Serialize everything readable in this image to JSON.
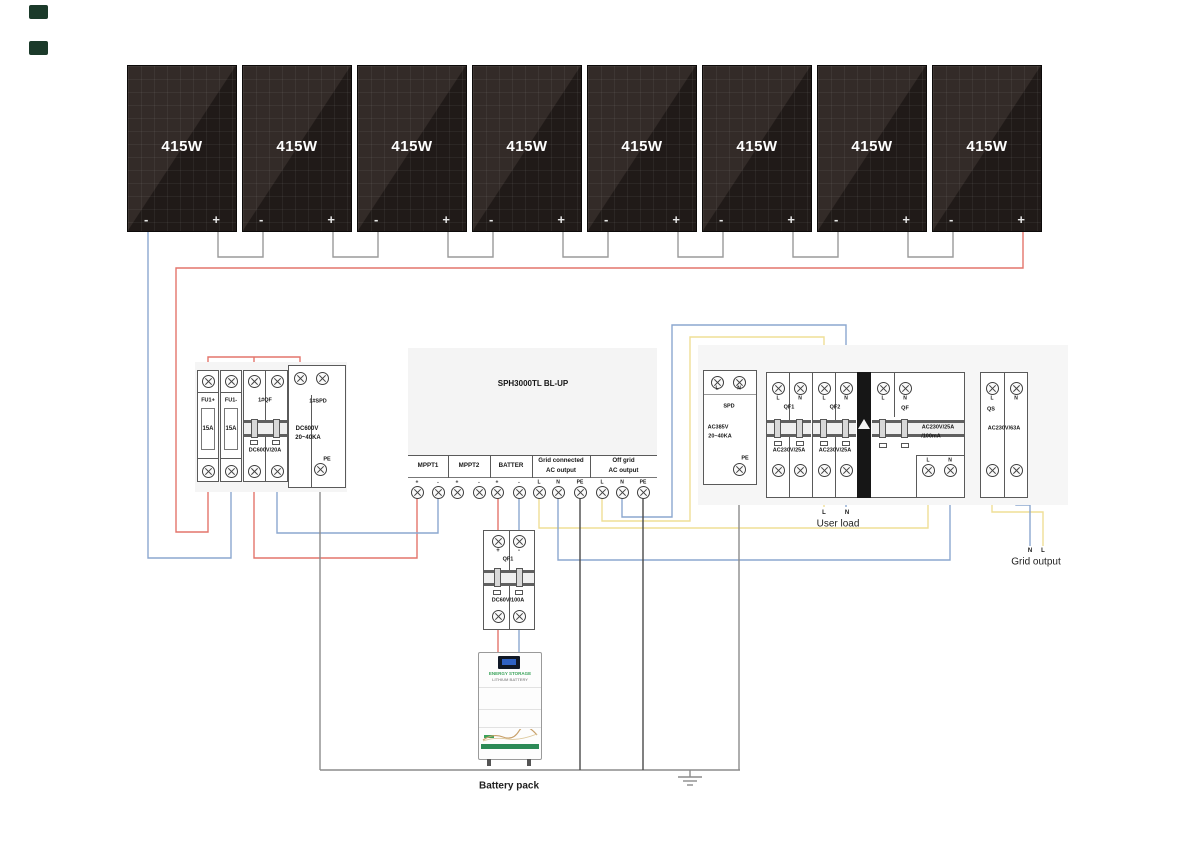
{
  "panels": {
    "count": 8,
    "wattage": "415W",
    "minus": "-",
    "plus": "+"
  },
  "combiner": {
    "fuse1": {
      "label": "FU1+",
      "rating": "15A"
    },
    "fuse2": {
      "label": "FU1-",
      "rating": "15A"
    },
    "breaker": {
      "label": "1#QF",
      "rating": "DC600V/20A"
    },
    "spd": {
      "label": "1#SPD",
      "line1": "DC600V",
      "line2": "20~40KA",
      "pe": "PE"
    }
  },
  "inverter": {
    "title": "SPH3000TL BL-UP",
    "sections": [
      {
        "name_lines": [
          "MPPT1"
        ],
        "terminals": [
          "+",
          "-"
        ]
      },
      {
        "name_lines": [
          "MPPT2"
        ],
        "terminals": [
          "+",
          "-"
        ]
      },
      {
        "name_lines": [
          "BATTER"
        ],
        "terminals": [
          "+",
          "-"
        ]
      },
      {
        "name_lines": [
          "Grid connected",
          "AC output"
        ],
        "terminals": [
          "L",
          "N",
          "PE"
        ]
      },
      {
        "name_lines": [
          "Off grid",
          "AC output"
        ],
        "terminals": [
          "L",
          "N",
          "PE"
        ]
      }
    ]
  },
  "ac_spd": {
    "label": "SPD",
    "line1": "AC385V",
    "line2": "20~40KA",
    "l": "L",
    "n": "N",
    "pe": "PE"
  },
  "qf1": {
    "label": "QF1",
    "rating": "AC230V/25A",
    "l": "L",
    "n": "N"
  },
  "qf2": {
    "label": "QF2",
    "rating": "AC230V/25A",
    "l": "L",
    "n": "N"
  },
  "qf_rcd": {
    "label": "QF",
    "rating1": "AC230V/25A",
    "rating2": "/100mA",
    "l": "L",
    "n": "N",
    "bottom_l": "L",
    "bottom_n": "N"
  },
  "qs": {
    "label": "QS",
    "rating": "AC230V/63A",
    "l": "L",
    "n": "N"
  },
  "battery_breaker": {
    "label": "QF1",
    "rating": "DC60V/100A",
    "plus": "+",
    "minus": "-"
  },
  "battery": {
    "line1": "ENERGY STORAGE",
    "line2": "LITHIUM BATTERY",
    "caption": "Battery pack"
  },
  "labels": {
    "user_load": {
      "l": "L",
      "n": "N",
      "text": "User load"
    },
    "grid_output": {
      "n": "N",
      "l": "L",
      "text": "Grid output"
    }
  },
  "colors": {
    "pv_positive": "#e4756b",
    "pv_negative": "#8ba7cf",
    "line_live": "#efdf96",
    "line_neutral": "#8ba7cf",
    "pe_gray": "#8c8c8c",
    "pe_black": "#4a4a4a",
    "link_gray": "#9a9a9a"
  },
  "wires": [
    {
      "c": "pv_positive",
      "p": [
        [
          1023,
          230
        ],
        [
          1023,
          268
        ],
        [
          176,
          268
        ],
        [
          176,
          532
        ],
        [
          208,
          532
        ],
        [
          208,
          477
        ]
      ]
    },
    {
      "c": "pv_positive",
      "p": [
        [
          208,
          375
        ],
        [
          208,
          357
        ],
        [
          300,
          357
        ],
        [
          300,
          372
        ]
      ]
    },
    {
      "c": "pv_positive",
      "p": [
        [
          254,
          357
        ],
        [
          254,
          375
        ]
      ]
    },
    {
      "c": "pv_positive",
      "p": [
        [
          254,
          477
        ],
        [
          254,
          558
        ],
        [
          417,
          558
        ],
        [
          417,
          498
        ]
      ]
    },
    {
      "c": "pv_positive",
      "p": [
        [
          498,
          498
        ],
        [
          498,
          536
        ]
      ]
    },
    {
      "c": "pv_positive",
      "p": [
        [
          498,
          622
        ],
        [
          498,
          652
        ]
      ]
    },
    {
      "c": "pv_negative",
      "p": [
        [
          148,
          230
        ],
        [
          148,
          558
        ],
        [
          231,
          558
        ],
        [
          231,
          477
        ]
      ]
    },
    {
      "c": "pv_negative",
      "p": [
        [
          231,
          375
        ],
        [
          231,
          364
        ],
        [
          322,
          364
        ],
        [
          322,
          372
        ]
      ]
    },
    {
      "c": "pv_negative",
      "p": [
        [
          277,
          364
        ],
        [
          277,
          375
        ]
      ]
    },
    {
      "c": "pv_negative",
      "p": [
        [
          277,
          477
        ],
        [
          277,
          533
        ],
        [
          438,
          533
        ],
        [
          438,
          498
        ]
      ]
    },
    {
      "c": "pv_negative",
      "p": [
        [
          519,
          498
        ],
        [
          519,
          536
        ]
      ]
    },
    {
      "c": "pv_negative",
      "p": [
        [
          519,
          622
        ],
        [
          519,
          652
        ]
      ]
    },
    {
      "c": "line_live",
      "p": [
        [
          539,
          498
        ],
        [
          539,
          528
        ],
        [
          928,
          528
        ],
        [
          928,
          476
        ]
      ]
    },
    {
      "c": "line_live",
      "p": [
        [
          602,
          498
        ],
        [
          602,
          521
        ],
        [
          690,
          521
        ],
        [
          690,
          337
        ],
        [
          824,
          337
        ],
        [
          824,
          382
        ]
      ]
    },
    {
      "c": "line_live",
      "p": [
        [
          824,
          476
        ],
        [
          824,
          507
        ]
      ]
    },
    {
      "c": "line_live",
      "p": [
        [
          778,
          476
        ],
        [
          778,
          483
        ],
        [
          763,
          483
        ],
        [
          763,
          357
        ],
        [
          717,
          357
        ],
        [
          717,
          376
        ]
      ]
    },
    {
      "c": "line_live",
      "p": [
        [
          763,
          357
        ],
        [
          883,
          357
        ],
        [
          883,
          382
        ]
      ]
    },
    {
      "c": "line_live",
      "p": [
        [
          778,
          382
        ],
        [
          778,
          347
        ],
        [
          992,
          347
        ],
        [
          992,
          382
        ]
      ]
    },
    {
      "c": "line_live",
      "p": [
        [
          992,
          476
        ],
        [
          992,
          512
        ],
        [
          1043,
          512
        ],
        [
          1043,
          546
        ]
      ]
    },
    {
      "c": "line_neutral",
      "p": [
        [
          558,
          498
        ],
        [
          558,
          560
        ],
        [
          950,
          560
        ],
        [
          950,
          476
        ]
      ]
    },
    {
      "c": "line_neutral",
      "p": [
        [
          622,
          498
        ],
        [
          622,
          517
        ],
        [
          672,
          517
        ],
        [
          672,
          325
        ],
        [
          846,
          325
        ],
        [
          846,
          382
        ]
      ]
    },
    {
      "c": "line_neutral",
      "p": [
        [
          846,
          476
        ],
        [
          846,
          507
        ]
      ]
    },
    {
      "c": "line_neutral",
      "p": [
        [
          800,
          476
        ],
        [
          800,
          490
        ],
        [
          748,
          490
        ],
        [
          748,
          365
        ],
        [
          739,
          365
        ],
        [
          739,
          376
        ]
      ]
    },
    {
      "c": "line_neutral",
      "p": [
        [
          748,
          365
        ],
        [
          905,
          365
        ],
        [
          905,
          382
        ]
      ]
    },
    {
      "c": "line_neutral",
      "p": [
        [
          800,
          382
        ],
        [
          800,
          352
        ],
        [
          1016,
          352
        ],
        [
          1016,
          382
        ]
      ]
    },
    {
      "c": "line_neutral",
      "p": [
        [
          1016,
          476
        ],
        [
          1016,
          505
        ],
        [
          1030,
          505
        ],
        [
          1030,
          546
        ]
      ]
    },
    {
      "c": "pe_gray",
      "p": [
        [
          320,
          475
        ],
        [
          320,
          770
        ]
      ]
    },
    {
      "c": "pe_gray",
      "p": [
        [
          739,
          475
        ],
        [
          739,
          770
        ]
      ]
    },
    {
      "c": "pe_gray",
      "p": [
        [
          320,
          770
        ],
        [
          740,
          770
        ]
      ]
    },
    {
      "c": "pe_gray",
      "p": [
        [
          690,
          770
        ],
        [
          690,
          777
        ]
      ]
    },
    {
      "c": "pe_gray",
      "p": [
        [
          678,
          777
        ],
        [
          702,
          777
        ]
      ]
    },
    {
      "c": "pe_gray",
      "p": [
        [
          683,
          781
        ],
        [
          697,
          781
        ]
      ]
    },
    {
      "c": "pe_gray",
      "p": [
        [
          687,
          785
        ],
        [
          693,
          785
        ]
      ]
    },
    {
      "c": "pe_black",
      "p": [
        [
          580,
          498
        ],
        [
          580,
          770
        ]
      ]
    },
    {
      "c": "pe_black",
      "p": [
        [
          643,
          498
        ],
        [
          643,
          770
        ]
      ]
    }
  ]
}
